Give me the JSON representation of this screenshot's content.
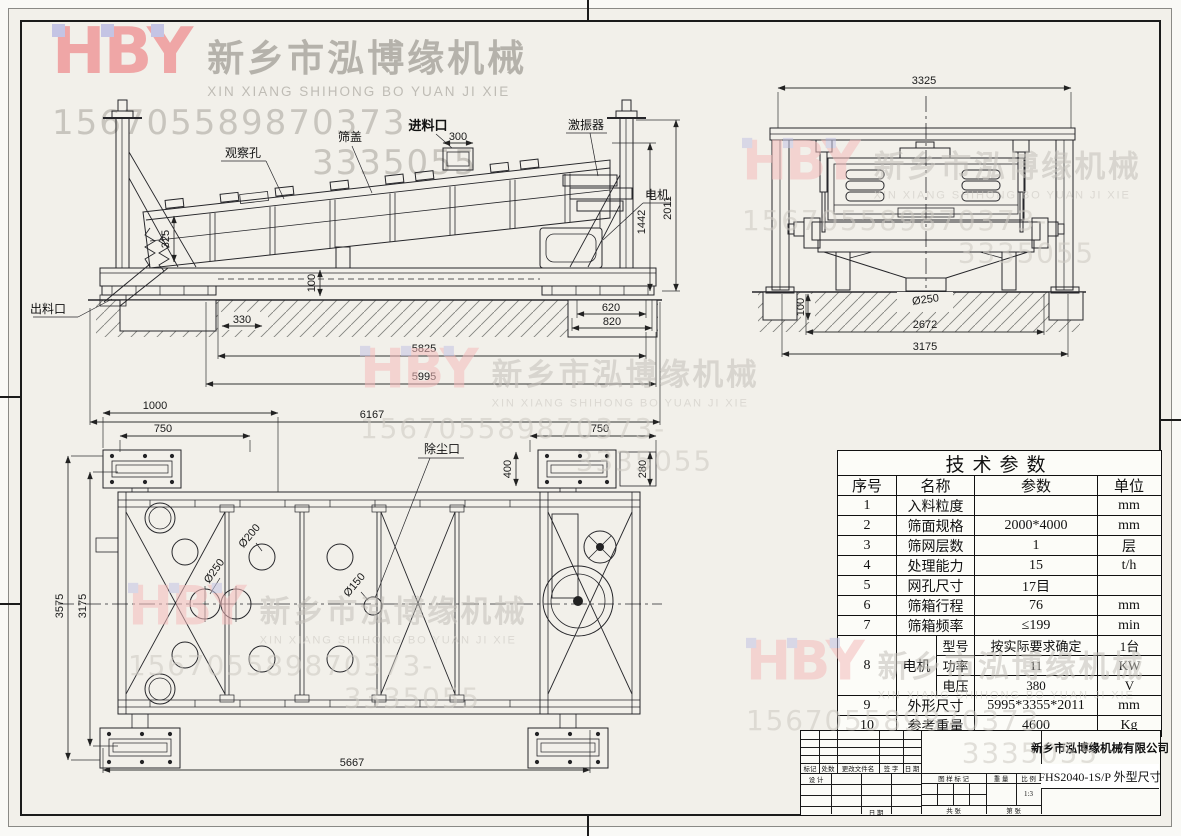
{
  "colors": {
    "sheet_bg": "#f2f0ea",
    "line": "#1b1b1b",
    "logo_pink": "#efa6a6",
    "logo_square_blue": "#c4c4e4",
    "watermark_gray": "#c3c0b9",
    "table_bg": "#fcfcf8"
  },
  "watermark": {
    "logo": "HBY",
    "company_cn": "新乡市泓博缘机械",
    "company_en": "XIN XIANG SHIHONG BO YUAN JI XIE",
    "phone1": "15670558987",
    "phone2": "0373-3335055"
  },
  "side_view": {
    "labels": {
      "observation_hole": "观察孔",
      "screen_cover": "筛盖",
      "feed_inlet": "进料口",
      "exciter": "激振器",
      "motor": "电机",
      "discharge_outlet": "出料口"
    },
    "dims": {
      "inlet_width": "300",
      "screen_depth": "325",
      "left_offset": "330",
      "base_height": "100",
      "foundation_620": "620",
      "foundation_820": "820",
      "motor_height": "1442",
      "total_height": "2011",
      "span_5825": "5825",
      "span_5995": "5995",
      "span_6167": "6167"
    }
  },
  "front_view": {
    "dims": {
      "width_3325": "3325",
      "height_100": "100",
      "outlet_dia": "Ø250",
      "span_2672": "2672",
      "span_3175": "3175"
    }
  },
  "plan_view": {
    "labels": {
      "dust_port": "除尘口"
    },
    "dims": {
      "plate_1000": "1000",
      "plate_750_left": "750",
      "plate_750_right": "750",
      "side_400": "400",
      "side_280": "280",
      "width_3575": "3575",
      "width_3175": "3175",
      "length_5667": "5667",
      "hole_200": "Ø200",
      "hole_250": "Ø250",
      "hole_150": "Ø150"
    }
  },
  "parameters_table": {
    "title": "技术参数",
    "headers": {
      "no": "序号",
      "name": "名称",
      "param": "参数",
      "unit": "单位"
    },
    "rows": [
      {
        "no": "1",
        "name": "入料粒度",
        "param": "",
        "unit": "mm"
      },
      {
        "no": "2",
        "name": "筛面规格",
        "param": "2000*4000",
        "unit": "mm"
      },
      {
        "no": "3",
        "name": "筛网层数",
        "param": "1",
        "unit": "层"
      },
      {
        "no": "4",
        "name": "处理能力",
        "param": "15",
        "unit": "t/h"
      },
      {
        "no": "5",
        "name": "网孔尺寸",
        "param": "17目",
        "unit": ""
      },
      {
        "no": "6",
        "name": "筛箱行程",
        "param": "76",
        "unit": "mm"
      },
      {
        "no": "7",
        "name": "筛箱频率",
        "param": "≤199",
        "unit": "min"
      }
    ],
    "motor": {
      "no": "8",
      "name": "电机",
      "subrows": [
        {
          "label": "型号",
          "param": "按实际要求确定",
          "unit": "1台"
        },
        {
          "label": "功率",
          "param": "11",
          "unit": "KW"
        },
        {
          "label": "电压",
          "param": "380",
          "unit": "V"
        }
      ]
    },
    "rows2": [
      {
        "no": "9",
        "name": "外形尺寸",
        "param": "5995*3355*2011",
        "unit": "mm"
      },
      {
        "no": "10",
        "name": "参考重量",
        "param": "4600",
        "unit": "Kg"
      }
    ]
  },
  "title_block": {
    "company": "新乡市泓博缘机械有限公司",
    "drawing_title": "FHS2040-1S/P  外型尺寸",
    "rev_headers": [
      "标记",
      "处数",
      "更改文件名",
      "签 字",
      "日 期"
    ],
    "design_label": "设 计",
    "date_label": "日 期",
    "mark_label": "图 样 标 记",
    "weight_label": "重 量",
    "scale_label": "比 例",
    "scale_value": "1:3",
    "sheets_label": "共  张",
    "sheet_no_label": "第  张"
  }
}
